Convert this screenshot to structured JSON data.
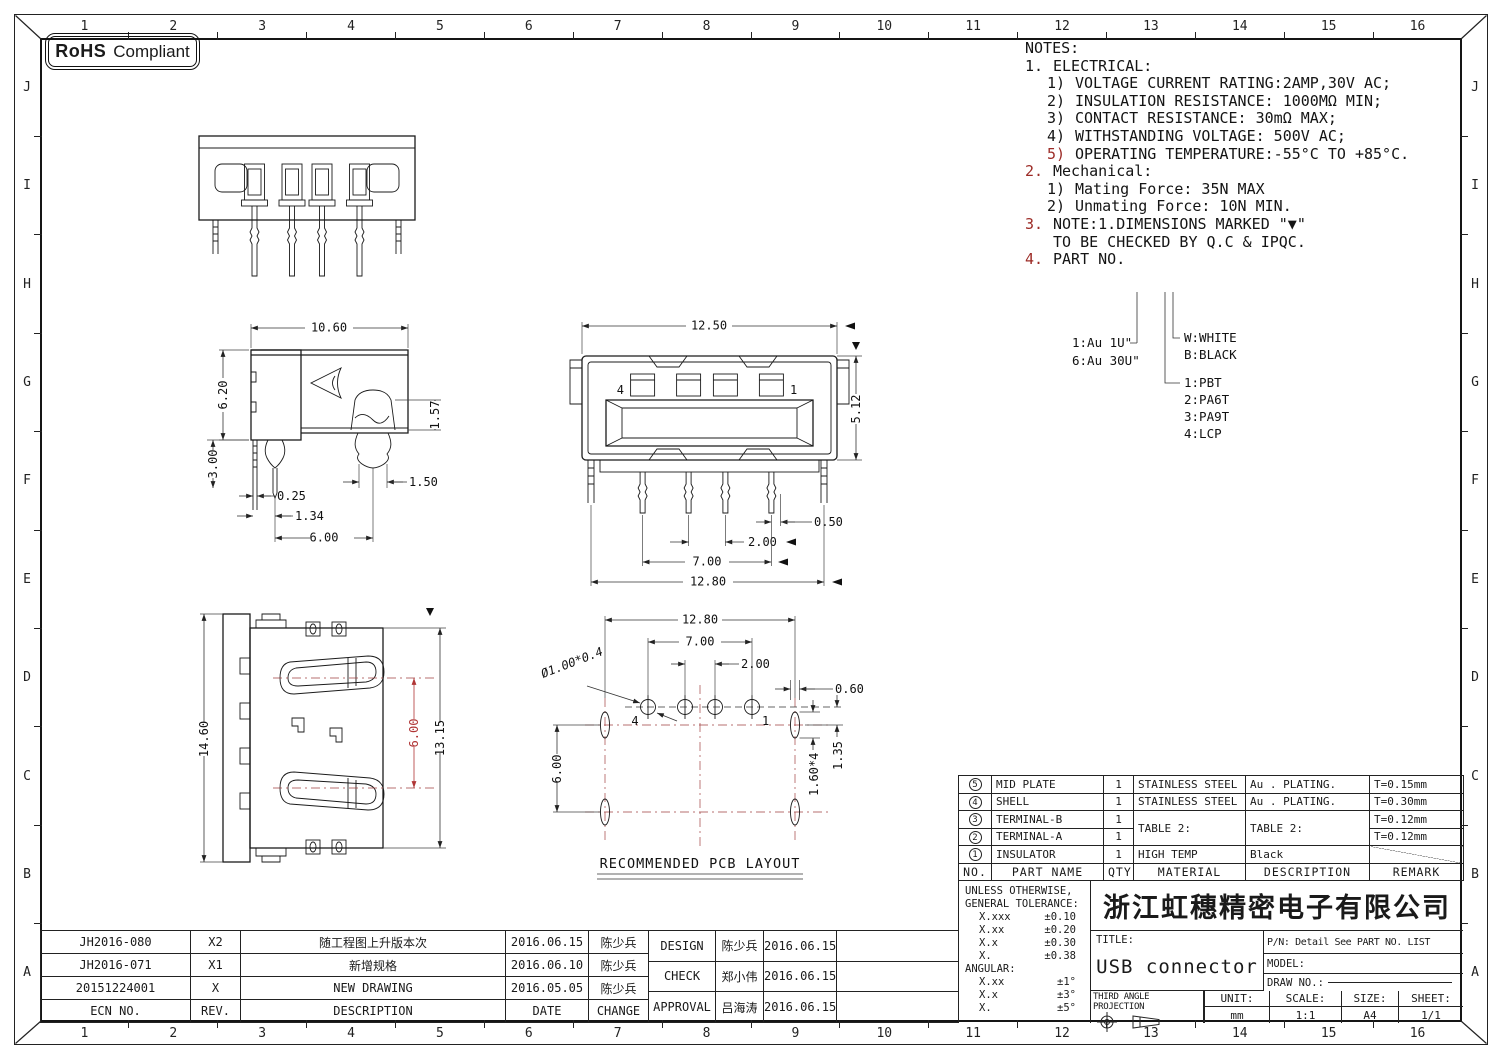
{
  "rohs": {
    "strong": "RoHS",
    "normal": "Compliant"
  },
  "grid": {
    "cols": [
      "1",
      "2",
      "3",
      "4",
      "5",
      "6",
      "7",
      "8",
      "9",
      "10",
      "11",
      "12",
      "13",
      "14",
      "15",
      "16"
    ],
    "rows": [
      "J",
      "I",
      "H",
      "G",
      "F",
      "E",
      "D",
      "C",
      "B",
      "A"
    ]
  },
  "notes": {
    "title": "NOTES:",
    "lines": [
      {
        "m": "1.",
        "t": "ELECTRICAL:"
      },
      {
        "m": "1)",
        "t": "VOLTAGE CURRENT RATING:2AMP,30V AC;"
      },
      {
        "m": "2)",
        "t": "INSULATION RESISTANCE: 1000MΩ MIN;"
      },
      {
        "m": "3)",
        "t": "CONTACT RESISTANCE: 30mΩ MAX;"
      },
      {
        "m": "4)",
        "t": "WITHSTANDING VOLTAGE: 500V AC;"
      },
      {
        "m": "5)",
        "t": "OPERATING TEMPERATURE:-55°C TO +85°C."
      },
      {
        "m": "2.",
        "t": "Mechanical:"
      },
      {
        "m": "1)",
        "t": "Mating Force:  35N MAX"
      },
      {
        "m": "2)",
        "t": "Unmating Force:  10N MIN."
      },
      {
        "m": "3.",
        "t": "NOTE:1.DIMENSIONS MARKED \"▼\""
      },
      {
        "m": "",
        "t": "TO BE CHECKED BY Q.C & IPQC."
      },
      {
        "m": "4.",
        "t": "PART NO."
      }
    ]
  },
  "legend": {
    "plating_1": "1:Au 1U\"",
    "plating_6": "6:Au 30U\"",
    "color_w": "W:WHITE",
    "color_b": "B:BLACK",
    "mat_1": "1:PBT",
    "mat_2": "2:PA6T",
    "mat_3": "3:PA9T",
    "mat_4": "4:LCP"
  },
  "views": {
    "side": {
      "w": "10.60",
      "h": "6.20",
      "peg_h": "1.57",
      "peg_w": "1.50",
      "pin_w": "0.25",
      "pin_off": "1.34",
      "peg_span": "6.00",
      "pin_len": "3.00"
    },
    "front": {
      "w": "12.50",
      "h": "5.12",
      "d050": "0.50",
      "pitch": "2.00",
      "span": "7.00",
      "total": "12.80",
      "pin_l": "4",
      "pin_r": "1"
    },
    "bottom": {
      "h": "14.60",
      "contact_span": "6.00",
      "body_h": "13.15"
    },
    "pcb": {
      "total": "12.80",
      "span": "7.00",
      "pitch": "2.00",
      "slot_w": "0.60",
      "hole": "Ø1.00*0.4",
      "slot_span": "6.00",
      "slot_len": "1.60*4",
      "offset": "1.35",
      "pin_l": "4",
      "pin_r": "1",
      "title": "RECOMMENDED PCB LAYOUT"
    }
  },
  "parts_table": {
    "headers": {
      "no": "NO.",
      "name": "PART NAME",
      "qty": "QTY",
      "material": "MATERIAL",
      "description": "DESCRIPTION",
      "remark": "REMARK"
    },
    "rows": [
      {
        "no": "5",
        "name": "MID PLATE",
        "qty": "1",
        "material": "STAINLESS STEEL",
        "description": "Au . PLATING.",
        "remark": "T=0.15mm"
      },
      {
        "no": "4",
        "name": "SHELL",
        "qty": "1",
        "material": "STAINLESS STEEL",
        "description": "Au . PLATING.",
        "remark": "T=0.30mm"
      },
      {
        "no": "3",
        "name": "TERMINAL-B",
        "qty": "1",
        "material": "TABLE 2:",
        "description": "TABLE 2:",
        "remark": "T=0.12mm"
      },
      {
        "no": "2",
        "name": "TERMINAL-A",
        "qty": "1",
        "remark": "T=0.12mm"
      },
      {
        "no": "1",
        "name": "INSULATOR",
        "qty": "1",
        "material": "HIGH TEMP",
        "description": "Black",
        "remark": ""
      }
    ]
  },
  "title_block": {
    "tolerance": {
      "l1": "UNLESS OTHERWISE,",
      "l2": "GENERAL TOLERANCE:",
      "rows": [
        {
          "k": "X.xxx",
          "v": "±0.10"
        },
        {
          "k": "X.xx",
          "v": "±0.20"
        },
        {
          "k": "X.x",
          "v": "±0.30"
        },
        {
          "k": "X.",
          "v": "±0.38"
        }
      ],
      "angular_label": "ANGULAR:",
      "angular_rows": [
        {
          "k": "X.xx",
          "v": "±1°"
        },
        {
          "k": "X.x",
          "v": "±3°"
        },
        {
          "k": "X.",
          "v": "±5°"
        }
      ]
    },
    "company": "浙江虹穗精密电子有限公司",
    "title_label": "TITLE:",
    "title_value": "USB connector",
    "pn": "P/N: Detail See PART NO. LIST",
    "model_label": "MODEL:",
    "draw_no_label": "DRAW NO.:",
    "projection_label": "THIRD ANGLE PROJECTION",
    "unit_label": "UNIT:",
    "unit_value": "mm",
    "scale_label": "SCALE:",
    "scale_value": "1:1",
    "size_label": "SIZE:",
    "size_value": "A4",
    "sheet_label": "SHEET:",
    "sheet_value": "1/1"
  },
  "revisions": {
    "headers": {
      "ecn": "ECN NO.",
      "rev": "REV.",
      "description": "DESCRIPTION",
      "date": "DATE",
      "change": "CHANGE"
    },
    "rows": [
      {
        "ecn": "JH2016-080",
        "rev": "X2",
        "description": "随工程图上升版本次",
        "date": "2016.06.15",
        "change": "陈少兵"
      },
      {
        "ecn": "JH2016-071",
        "rev": "X1",
        "description": "新增规格",
        "date": "2016.06.10",
        "change": "陈少兵"
      },
      {
        "ecn": "20151224001",
        "rev": "X",
        "description": "NEW DRAWING",
        "date": "2016.05.05",
        "change": "陈少兵"
      }
    ]
  },
  "approvals": [
    {
      "role": "DESIGN",
      "name": "陈少兵",
      "date": "2016.06.15"
    },
    {
      "role": "CHECK",
      "name": "郑小伟",
      "date": "2016.06.15"
    },
    {
      "role": "APPROVAL",
      "name": "吕海涛",
      "date": "2016.06.15"
    }
  ]
}
